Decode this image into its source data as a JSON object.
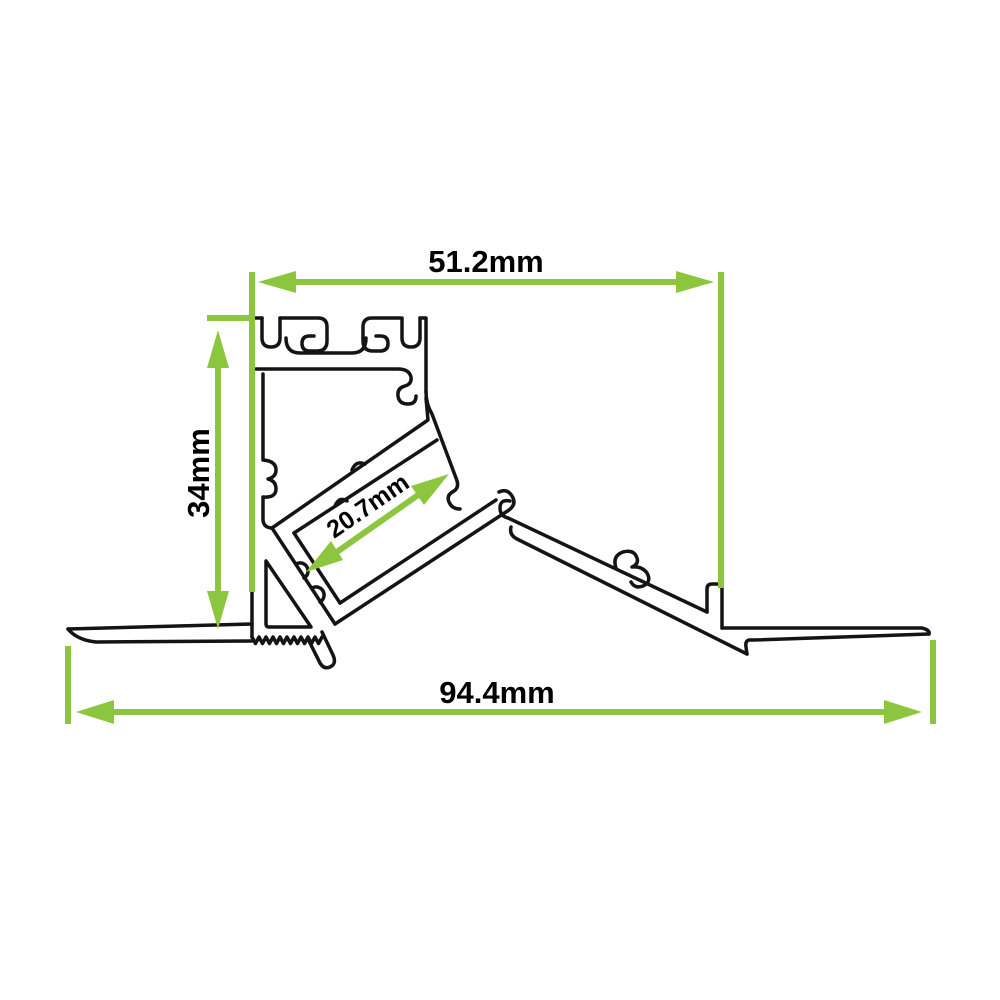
{
  "drawing": {
    "background": "#ffffff",
    "outline_color": "#141414",
    "dimension_color": "#8cc63f",
    "label_color": "#000000",
    "dimensions": {
      "top_width": "51.2mm",
      "side_height": "34mm",
      "channel_width": "20.7mm",
      "overall_width": "94.4mm"
    }
  }
}
